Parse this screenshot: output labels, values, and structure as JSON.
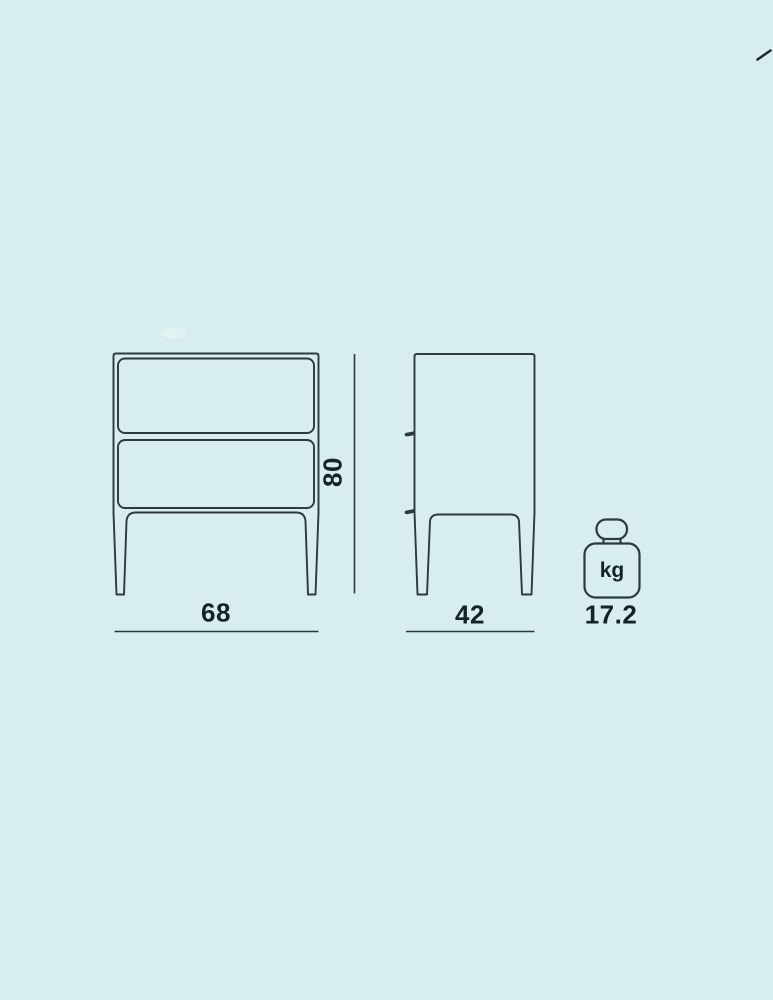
{
  "colors": {
    "background": "#d7edef",
    "line": "#2b3940",
    "text": "#14222a"
  },
  "diagram": {
    "type": "furniture-dimension-drawing",
    "front_view": {
      "width": "68",
      "height": "80",
      "drawer_count": 2
    },
    "side_view": {
      "depth": "42"
    },
    "weight": {
      "value": "17.2",
      "unit": "kg",
      "icon": "kilogram-weight-icon"
    }
  }
}
